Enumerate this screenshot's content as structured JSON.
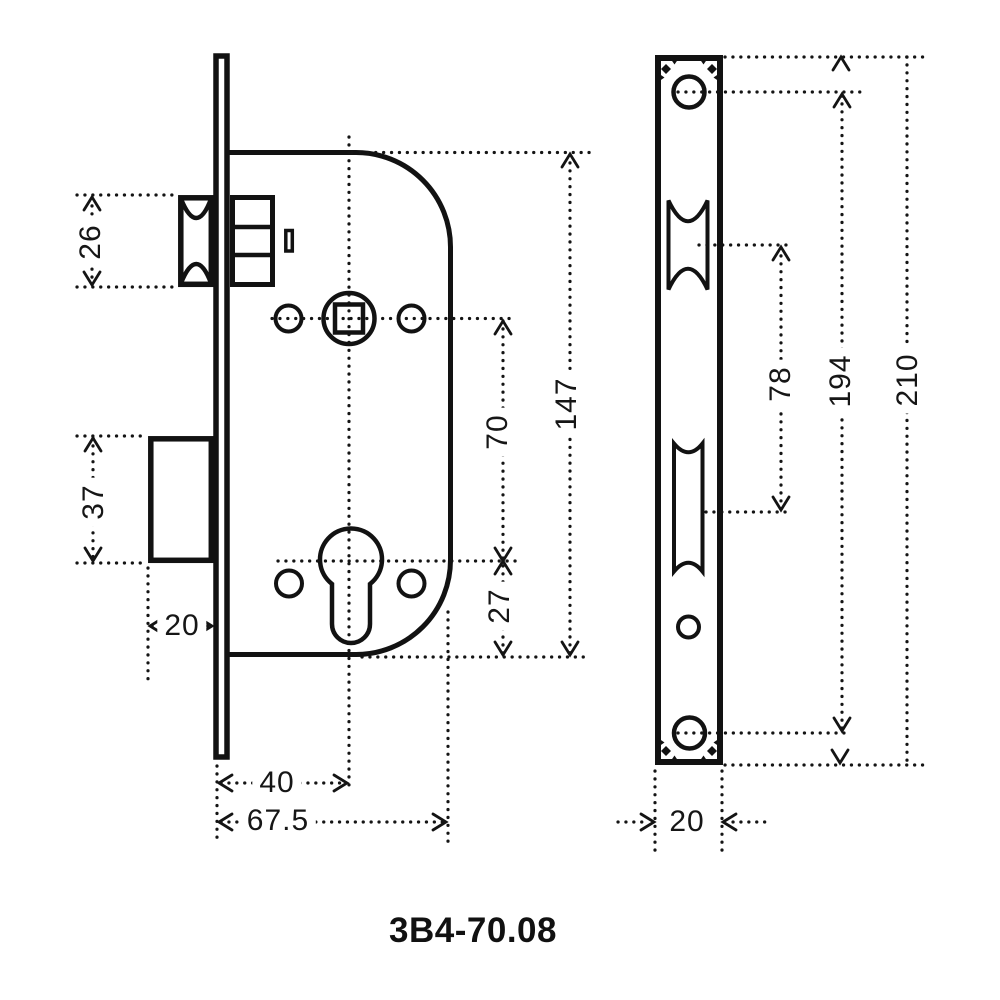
{
  "title": "3B4-70.08",
  "dimensions_mm": {
    "latch_bolt_height": "26",
    "deadbolt_height": "37",
    "deadbolt_throw": "20",
    "backset": "40",
    "body_depth": "67.5",
    "spindle_to_cylinder": "70",
    "cylinder_to_bottom": "27",
    "body_height": "147",
    "latch_to_deadbolt": "78",
    "screw_spacing": "194",
    "faceplate_length": "210",
    "faceplate_width": "20"
  },
  "colors": {
    "line": "#121212",
    "background": "#ffffff"
  }
}
